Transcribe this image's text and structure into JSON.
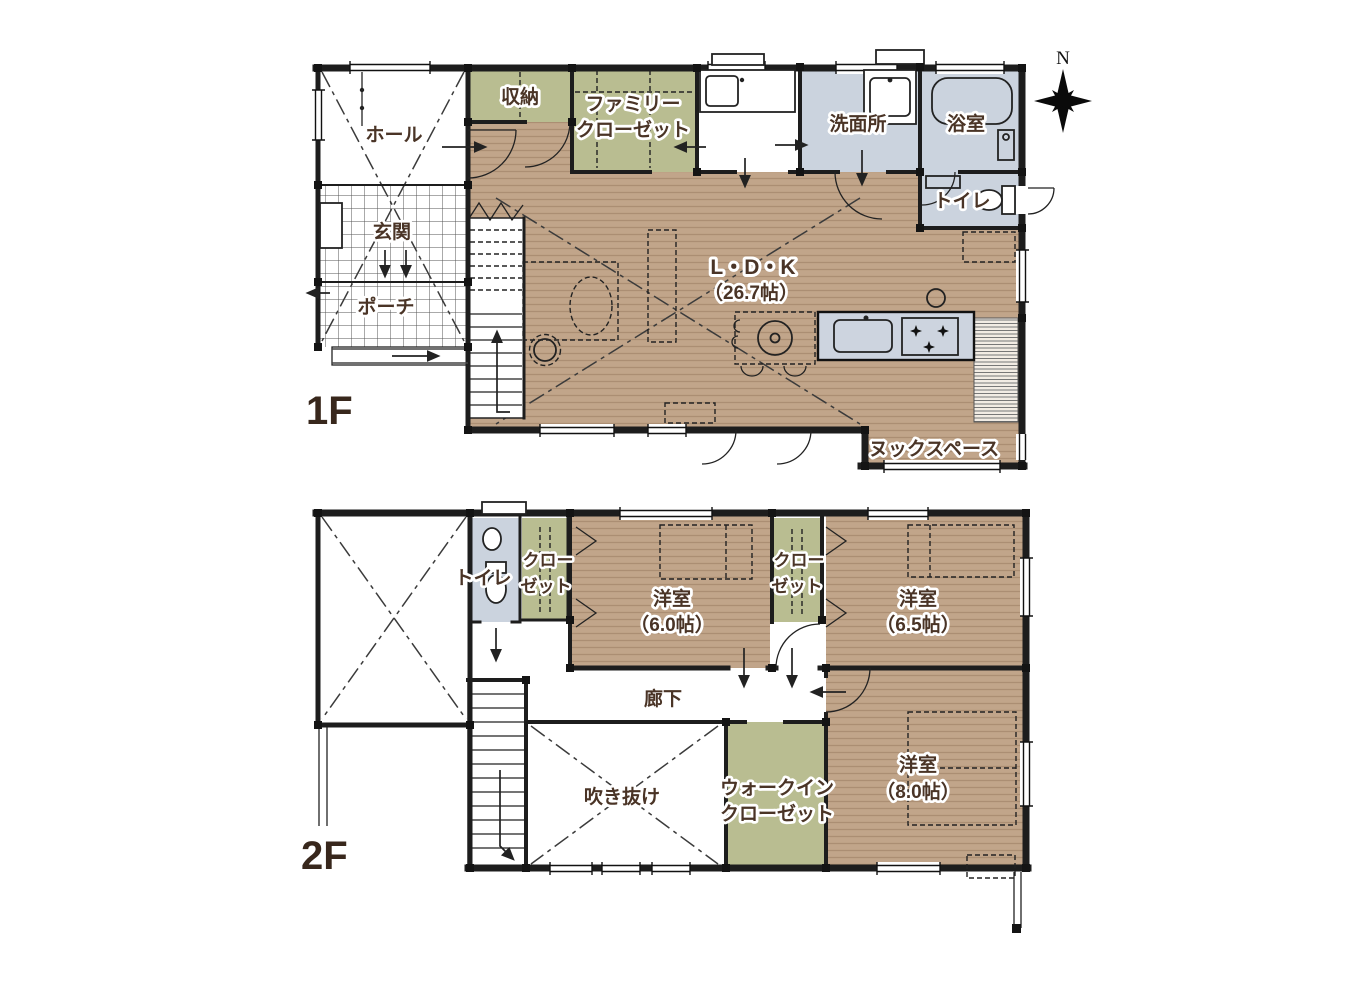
{
  "colors": {
    "wood_base": "#c1a58a",
    "wood_stripe": "#ab8e73",
    "closet_green": "#b9bd91",
    "wet_blue": "#cbd3de",
    "counter_blue": "#cdd4df",
    "wall": "#1d1d1d",
    "label_brown": "#4a3426",
    "floor_label_brown": "#38271c"
  },
  "compass": {
    "north_label": "N"
  },
  "floor1": {
    "label": "1F",
    "rooms": {
      "hall": "ホール",
      "entrance": "玄関",
      "porch": "ポーチ",
      "storage": "収納",
      "family_closet_line1": "ファミリー",
      "family_closet_line2": "クローゼット",
      "washroom": "洗面所",
      "bathroom": "浴室",
      "toilet": "トイレ",
      "ldk_line1": "L・D・K",
      "ldk_line2": "（26.7帖）",
      "nook": "ヌックスペース"
    }
  },
  "floor2": {
    "label": "2F",
    "rooms": {
      "toilet": "トイレ",
      "closet_a_line1": "クロー",
      "closet_a_line2": "ゼット",
      "bedroom_6_0_line1": "洋室",
      "bedroom_6_0_line2": "（6.0帖）",
      "closet_b_line1": "クロー",
      "closet_b_line2": "ゼット",
      "bedroom_6_5_line1": "洋室",
      "bedroom_6_5_line2": "（6.5帖）",
      "corridor": "廊下",
      "void": "吹き抜け",
      "wic_line1": "ウォークイン",
      "wic_line2": "クローゼット",
      "bedroom_8_0_line1": "洋室",
      "bedroom_8_0_line2": "（8.0帖）"
    }
  }
}
